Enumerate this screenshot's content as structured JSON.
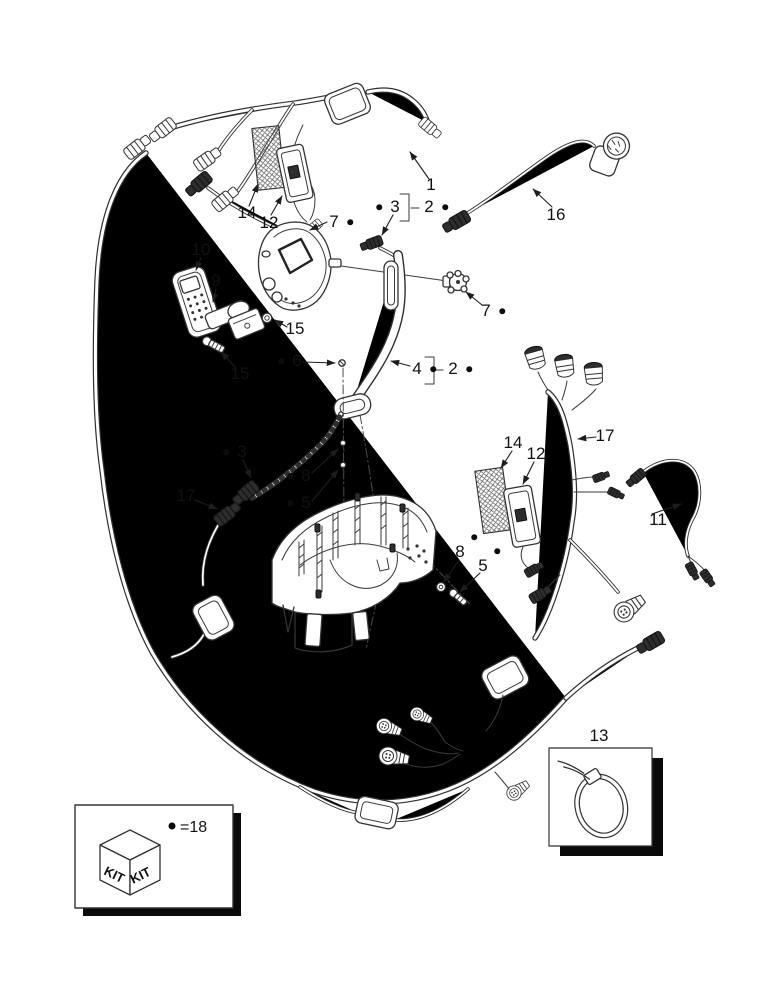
{
  "diagram": {
    "type": "parts-exploded-diagram",
    "subject": "wiring harness assembly",
    "callouts": [
      {
        "id": "1",
        "label": "1",
        "x": 431,
        "y": 186,
        "bullet": null
      },
      {
        "id": "14a",
        "label": "14",
        "x": 247,
        "y": 214,
        "bullet": null
      },
      {
        "id": "12a",
        "label": "12",
        "x": 269,
        "y": 224,
        "bullet": null
      },
      {
        "id": "7a",
        "label": "7",
        "x": 334,
        "y": 223,
        "bullet": "right"
      },
      {
        "id": "3a",
        "label": "3",
        "x": 395,
        "y": 208,
        "bullet": "left"
      },
      {
        "id": "2a",
        "label": "2",
        "x": 429,
        "y": 208,
        "bullet": "right"
      },
      {
        "id": "16",
        "label": "16",
        "x": 556,
        "y": 216,
        "bullet": null
      },
      {
        "id": "7b",
        "label": "7",
        "x": 486,
        "y": 312,
        "bullet": "right"
      },
      {
        "id": "10",
        "label": "10",
        "x": 201,
        "y": 251,
        "bullet": null
      },
      {
        "id": "9",
        "label": "9",
        "x": 216,
        "y": 282,
        "bullet": null
      },
      {
        "id": "15a",
        "label": "15",
        "x": 295,
        "y": 330,
        "bullet": null
      },
      {
        "id": "15b",
        "label": "15",
        "x": 240,
        "y": 375,
        "bullet": null
      },
      {
        "id": "6",
        "label": "6",
        "x": 297,
        "y": 362,
        "bullet": "left"
      },
      {
        "id": "4",
        "label": "4",
        "x": 417,
        "y": 370,
        "bullet": "right"
      },
      {
        "id": "2b",
        "label": "2",
        "x": 453,
        "y": 370,
        "bullet": "right"
      },
      {
        "id": "3b",
        "label": "3",
        "x": 242,
        "y": 453,
        "bullet": "left"
      },
      {
        "id": "8a",
        "label": "8",
        "x": 306,
        "y": 477,
        "bullet": "left"
      },
      {
        "id": "5a",
        "label": "5",
        "x": 306,
        "y": 504,
        "bullet": "left"
      },
      {
        "id": "17a",
        "label": "17",
        "x": 186,
        "y": 497,
        "bullet": null
      },
      {
        "id": "14b",
        "label": "14",
        "x": 513,
        "y": 444,
        "bullet": null
      },
      {
        "id": "12b",
        "label": "12",
        "x": 536,
        "y": 455,
        "bullet": null
      },
      {
        "id": "17b",
        "label": "17",
        "x": 605,
        "y": 437,
        "bullet": null
      },
      {
        "id": "11",
        "label": "11",
        "x": 658,
        "y": 521,
        "bullet": null
      },
      {
        "id": "8b",
        "label": "8",
        "x": 460,
        "y": 553,
        "bullet": "upright"
      },
      {
        "id": "5b",
        "label": "5",
        "x": 483,
        "y": 567,
        "bullet": "upright"
      },
      {
        "id": "13",
        "label": "13",
        "x": 599,
        "y": 737,
        "bullet": null
      }
    ],
    "kit_box": {
      "cube_label_left": "KIT",
      "cube_label_right": "KIT",
      "legend_text": "=18"
    },
    "ref_box_13": {
      "label": "13"
    }
  }
}
